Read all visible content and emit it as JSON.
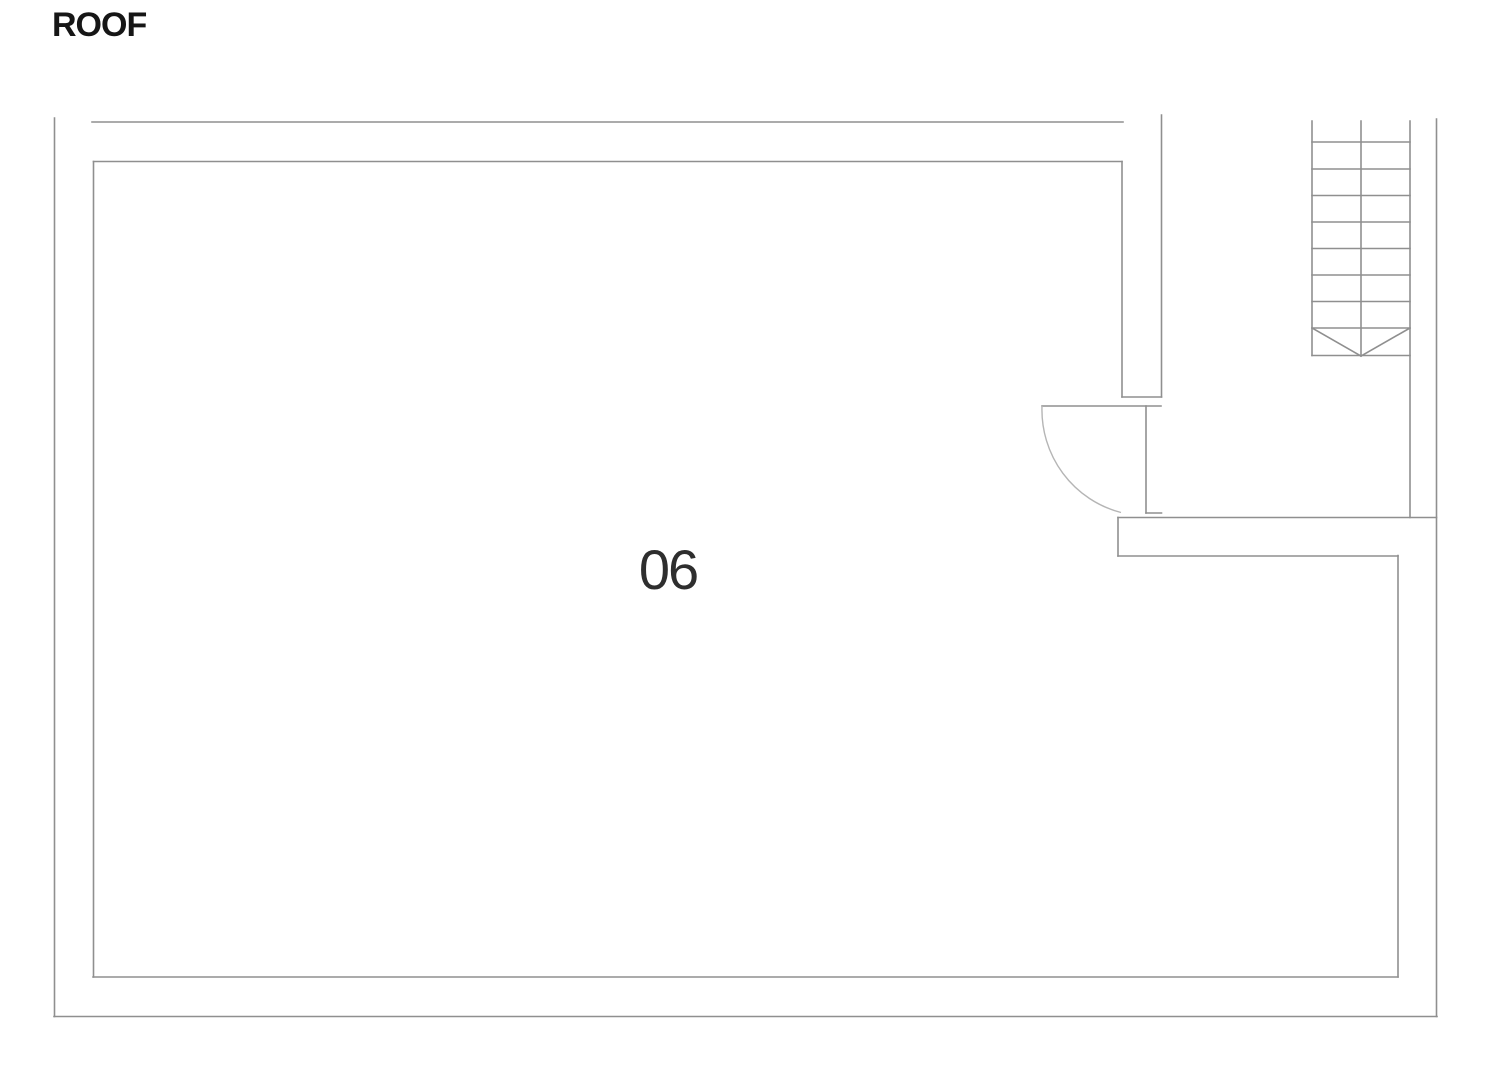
{
  "title": {
    "text": "ROOF",
    "color": "#161616"
  },
  "room": {
    "number": "06",
    "color": "#2e2e2e"
  },
  "plan": {
    "stroke_color": "#8f8f8f",
    "stroke_width": 1.6,
    "arc_color": "#b5b5b5",
    "walls": [
      {
        "name": "outer-left-wall",
        "x1": 54.5,
        "y1": 118,
        "x2": 54.5,
        "y2": 1016.5
      },
      {
        "name": "outer-bottom-wall",
        "x1": 54,
        "y1": 1016.5,
        "x2": 1437,
        "y2": 1016.5
      },
      {
        "name": "outer-right-wall",
        "x1": 1436.5,
        "y1": 119,
        "x2": 1436.5,
        "y2": 1016.5
      },
      {
        "name": "outer-top-wall",
        "x1": 92,
        "y1": 122,
        "x2": 1123,
        "y2": 122
      },
      {
        "name": "inner-top-wall",
        "x1": 93.5,
        "y1": 161.5,
        "x2": 1122,
        "y2": 161.5
      },
      {
        "name": "inner-left-wall",
        "x1": 93.5,
        "y1": 161.5,
        "x2": 93.5,
        "y2": 977
      },
      {
        "name": "inner-bottom-wall",
        "x1": 93,
        "y1": 977,
        "x2": 1398,
        "y2": 977
      },
      {
        "name": "inner-right-wall",
        "x1": 1398,
        "y1": 555.5,
        "x2": 1398,
        "y2": 977
      },
      {
        "name": "pier-left-edge",
        "x1": 1122,
        "y1": 161.5,
        "x2": 1122,
        "y2": 397
      },
      {
        "name": "pier-right-edge",
        "x1": 1161.5,
        "y1": 115,
        "x2": 1161.5,
        "y2": 397
      },
      {
        "name": "pier-bottom-edge",
        "x1": 1122,
        "y1": 397,
        "x2": 1161.5,
        "y2": 397
      },
      {
        "name": "lower-wall-top-edge",
        "x1": 1118,
        "y1": 517.5,
        "x2": 1436.5,
        "y2": 517.5
      },
      {
        "name": "lower-wall-left-edge",
        "x1": 1118,
        "y1": 517.5,
        "x2": 1118,
        "y2": 556
      },
      {
        "name": "lower-wall-inner-edge",
        "x1": 1118,
        "y1": 556,
        "x2": 1398,
        "y2": 556
      }
    ],
    "staircase": {
      "rails": [
        {
          "name": "stair-rail-left",
          "x1": 1312,
          "y1": 121,
          "x2": 1312,
          "y2": 355.5
        },
        {
          "name": "stair-rail-middle",
          "x1": 1361,
          "y1": 121,
          "x2": 1361,
          "y2": 356
        },
        {
          "name": "stair-rail-right",
          "x1": 1410,
          "y1": 121,
          "x2": 1410,
          "y2": 517.5
        }
      ],
      "tread_x1": 1312,
      "tread_x2": 1410,
      "tread_ys": [
        142,
        169,
        195.5,
        222,
        248.5,
        275,
        301.5,
        328,
        355.5
      ],
      "arrow": [
        {
          "name": "stair-arrow-left-diagonal",
          "x1": 1312,
          "y1": 328,
          "x2": 1361,
          "y2": 356
        },
        {
          "name": "stair-arrow-right-diagonal",
          "x1": 1410,
          "y1": 328,
          "x2": 1361,
          "y2": 356
        }
      ]
    },
    "door": {
      "leaf": {
        "name": "door-leaf-line",
        "x1": 1042,
        "y1": 406,
        "x2": 1161,
        "y2": 406
      },
      "frame": {
        "name": "door-frame-line",
        "x1": 1146,
        "y1": 406,
        "x2": 1146,
        "y2": 513
      },
      "sill": {
        "name": "door-sill-line",
        "x1": 1146,
        "y1": 513,
        "x2": 1161.5,
        "y2": 513
      },
      "arc_path": "M 1042 406 A 105 106 0 0 0 1121 512.5"
    }
  }
}
